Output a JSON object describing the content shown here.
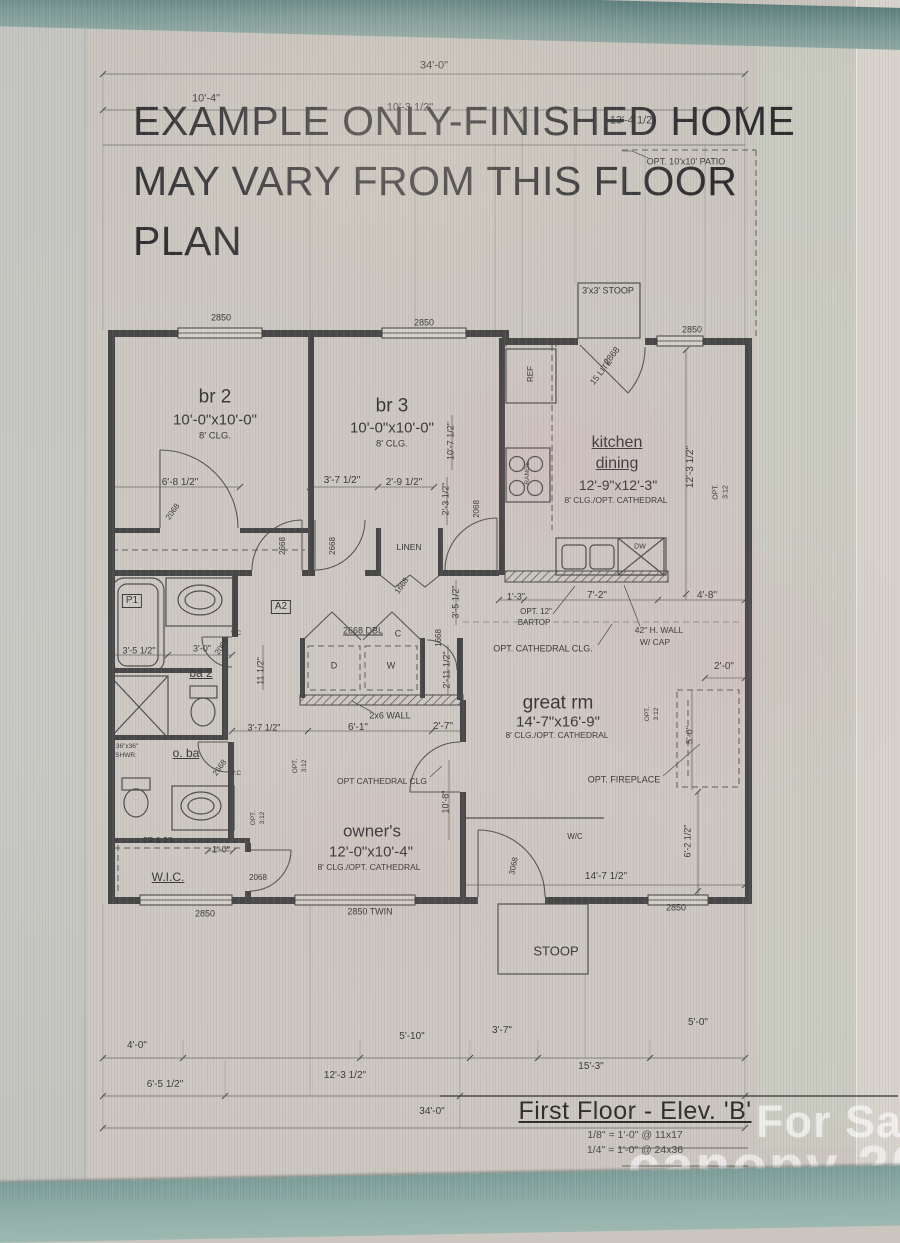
{
  "colors": {
    "teal_band": "#7c9a96",
    "paper": "#cac6bf",
    "wall": "#484848",
    "ink": "#3a3a3a",
    "watermark": "#ffffff"
  },
  "disclaimer": {
    "line1": "EXAMPLE ONLY-FINISHED HOME",
    "line2": "MAY VARY FROM THIS FLOOR",
    "line3": "PLAN"
  },
  "title_block": {
    "title": "First Floor - Elev. 'B'",
    "scale1": "1/8\" = 1'-0\" @ 11x17",
    "scale2": "1/4\" = 1'-0\" @ 24x36"
  },
  "watermarks": {
    "for_sale": "For Sale",
    "brand_year": "canopy 2026",
    "mls": "MLS"
  },
  "rooms": [
    {
      "name": "br 2",
      "size": "10'-0\"x10'-0\"",
      "ceiling": "8' CLG."
    },
    {
      "name": "br 3",
      "size": "10'-0\"x10'-0\"",
      "ceiling": "8' CLG."
    },
    {
      "name": "kitchen dining",
      "size": "12'-9\"x12'-3\"",
      "ceiling": "8' CLG./OPT. CATHEDRAL"
    },
    {
      "name": "great rm",
      "size": "14'-7\"x16'-9\"",
      "ceiling": "8' CLG./OPT. CATHEDRAL"
    },
    {
      "name": "owner's",
      "size": "12'-0\"x10'-4\"",
      "ceiling": "8' CLG./OPT. CATHEDRAL"
    },
    {
      "name": "ba 2"
    },
    {
      "name": "o. ba"
    },
    {
      "name": "W.I.C."
    },
    {
      "name": "LINEN"
    },
    {
      "name": "STOOP"
    }
  ],
  "plan_labels": [
    {
      "t": "34'-0\"",
      "x": 434,
      "y": 66,
      "s": 11,
      "n": "dim-overall-top"
    },
    {
      "t": "10'-4\"",
      "x": 206,
      "y": 99,
      "s": 11,
      "n": "dim"
    },
    {
      "t": "10'-3 1/2\"",
      "x": 410,
      "y": 108,
      "s": 11,
      "n": "dim"
    },
    {
      "t": "13'-4 1/2\"",
      "x": 633,
      "y": 121,
      "s": 11,
      "n": "dim"
    },
    {
      "t": "OPT. 10'x10' PATIO",
      "x": 686,
      "y": 162,
      "s": 9,
      "n": "note-opt-patio"
    },
    {
      "t": "3'x3' STOOP",
      "x": 608,
      "y": 291,
      "s": 9,
      "n": "label-stoop-top"
    },
    {
      "t": "2850",
      "x": 221,
      "y": 318,
      "s": 9,
      "n": "window-tag"
    },
    {
      "t": "2850",
      "x": 424,
      "y": 323,
      "s": 9,
      "n": "window-tag"
    },
    {
      "t": "2850",
      "x": 692,
      "y": 330,
      "s": 9,
      "n": "window-tag"
    },
    {
      "t": "2868",
      "x": 612,
      "y": 356,
      "s": 9,
      "r": -52,
      "n": "door-tag"
    },
    {
      "t": "15 LITE",
      "x": 601,
      "y": 372,
      "s": 8.5,
      "r": -52,
      "n": "door-tag"
    },
    {
      "t": "br 2",
      "x": 215,
      "y": 397,
      "s": 19,
      "n": "room-br2"
    },
    {
      "t": "10'-0\"x10'-0\"",
      "x": 215,
      "y": 420,
      "s": 15,
      "n": "room-br2-size"
    },
    {
      "t": "8' CLG.",
      "x": 215,
      "y": 436,
      "s": 9.5,
      "n": "room-br2-clg"
    },
    {
      "t": "br 3",
      "x": 392,
      "y": 406,
      "s": 19,
      "n": "room-br3"
    },
    {
      "t": "10'-0\"x10'-0\"",
      "x": 392,
      "y": 428,
      "s": 15,
      "n": "room-br3-size"
    },
    {
      "t": "8' CLG.",
      "x": 392,
      "y": 444,
      "s": 9.5,
      "n": "room-br3-clg"
    },
    {
      "t": "kitchen",
      "x": 617,
      "y": 443,
      "s": 16,
      "u": true,
      "n": "room-kitchen"
    },
    {
      "t": "dining",
      "x": 617,
      "y": 464,
      "s": 16,
      "u": true,
      "n": "room-dining"
    },
    {
      "t": "12'-9\"x12'-3\"",
      "x": 618,
      "y": 485,
      "s": 14,
      "n": "room-kitchen-size"
    },
    {
      "t": "8' CLG./OPT. CATHEDRAL",
      "x": 616,
      "y": 500,
      "s": 8.5,
      "n": "room-kitchen-clg"
    },
    {
      "t": "12'-3 1/2\"",
      "x": 691,
      "y": 467,
      "s": 10,
      "r": -90,
      "n": "dim"
    },
    {
      "t": "OPT.",
      "x": 716,
      "y": 492,
      "s": 7,
      "r": -90,
      "n": "roof-pitch"
    },
    {
      "t": "3:12",
      "x": 726,
      "y": 492,
      "s": 7,
      "r": -90,
      "n": "roof-pitch"
    },
    {
      "t": "REF",
      "x": 531,
      "y": 374,
      "s": 8,
      "r": -90,
      "n": "fixture-ref"
    },
    {
      "t": "RANGE",
      "x": 528,
      "y": 473,
      "s": 6.5,
      "r": -90,
      "n": "fixture-range"
    },
    {
      "t": "DW",
      "x": 640,
      "y": 547,
      "s": 7,
      "n": "fixture-dw"
    },
    {
      "t": "6'-8 1/2\"",
      "x": 180,
      "y": 483,
      "s": 10,
      "n": "dim"
    },
    {
      "t": "3'-7 1/2\"",
      "x": 342,
      "y": 481,
      "s": 10,
      "n": "dim"
    },
    {
      "t": "2'-9 1/2\"",
      "x": 404,
      "y": 483,
      "s": 10,
      "n": "dim"
    },
    {
      "t": "10'-7 1/2\"",
      "x": 451,
      "y": 441,
      "s": 9,
      "r": -90,
      "n": "dim"
    },
    {
      "t": "2'-3 1/2\"",
      "x": 446,
      "y": 499,
      "s": 9,
      "r": -90,
      "n": "dim"
    },
    {
      "t": "2068",
      "x": 477,
      "y": 509,
      "s": 8,
      "r": -90,
      "n": "door-tag"
    },
    {
      "t": "2068",
      "x": 173,
      "y": 512,
      "s": 8,
      "r": -55,
      "n": "door-tag"
    },
    {
      "t": "2668",
      "x": 283,
      "y": 546,
      "s": 8,
      "r": -90,
      "n": "door-tag"
    },
    {
      "t": "2668",
      "x": 333,
      "y": 546,
      "s": 8,
      "r": -90,
      "n": "door-tag"
    },
    {
      "t": "LINEN",
      "x": 409,
      "y": 547,
      "s": 8.5,
      "n": "label-linen"
    },
    {
      "t": "1668",
      "x": 402,
      "y": 586,
      "s": 8,
      "r": -55,
      "n": "door-tag"
    },
    {
      "t": "3'-5 1/2\"",
      "x": 456,
      "y": 602,
      "s": 9,
      "r": -90,
      "n": "dim"
    },
    {
      "t": "2'-11 1/2\"",
      "x": 447,
      "y": 670,
      "s": 9,
      "r": -90,
      "n": "dim"
    },
    {
      "t": "1668",
      "x": 439,
      "y": 638,
      "s": 8,
      "r": -90,
      "n": "door-tag"
    },
    {
      "t": "2668 DBL",
      "x": 363,
      "y": 631,
      "s": 9,
      "u": true,
      "n": "door-tag"
    },
    {
      "t": "C",
      "x": 398,
      "y": 634,
      "s": 9,
      "n": "label-closet"
    },
    {
      "t": "D",
      "x": 334,
      "y": 666,
      "s": 9,
      "n": "fixture-dryer"
    },
    {
      "t": "W",
      "x": 391,
      "y": 666,
      "s": 9,
      "n": "fixture-washer"
    },
    {
      "t": "2x6 WALL",
      "x": 390,
      "y": 716,
      "s": 9,
      "n": "note-2x6-wall"
    },
    {
      "t": "6'-1\"",
      "x": 358,
      "y": 728,
      "s": 10,
      "n": "dim"
    },
    {
      "t": "2'-7\"",
      "x": 443,
      "y": 727,
      "s": 10,
      "n": "dim"
    },
    {
      "t": "3'-7 1/2\"",
      "x": 264,
      "y": 728,
      "s": 9,
      "n": "dim"
    },
    {
      "t": "P1",
      "x": 132,
      "y": 601,
      "s": 10,
      "b": true,
      "n": "tag-p1"
    },
    {
      "t": "A2",
      "x": 281,
      "y": 607,
      "s": 10,
      "b": true,
      "n": "tag-a2"
    },
    {
      "t": "V.C",
      "x": 236,
      "y": 634,
      "s": 6.5,
      "n": "note-vc"
    },
    {
      "t": "V.C",
      "x": 236,
      "y": 774,
      "s": 6.5,
      "n": "note-vc"
    },
    {
      "t": "3'-5 1/2\"",
      "x": 139,
      "y": 651,
      "s": 9,
      "n": "dim"
    },
    {
      "t": "3'-0\"",
      "x": 202,
      "y": 649,
      "s": 9,
      "n": "dim"
    },
    {
      "t": "ba 2",
      "x": 201,
      "y": 673,
      "s": 12,
      "u": true,
      "n": "room-ba2"
    },
    {
      "t": "11 1/2\"",
      "x": 261,
      "y": 671,
      "s": 9,
      "r": -90,
      "n": "dim"
    },
    {
      "t": "2068",
      "x": 222,
      "y": 647,
      "s": 8,
      "r": -55,
      "n": "door-tag"
    },
    {
      "t": "36\"x36\"",
      "x": 127,
      "y": 747,
      "s": 6.5,
      "n": "fixture-shower-size"
    },
    {
      "t": "SHWR.",
      "x": 126,
      "y": 756,
      "s": 6.5,
      "n": "fixture-shower"
    },
    {
      "t": "o. ba",
      "x": 186,
      "y": 753,
      "s": 12,
      "u": true,
      "n": "room-oba"
    },
    {
      "t": "2668",
      "x": 220,
      "y": 768,
      "s": 8,
      "r": -55,
      "n": "door-tag"
    },
    {
      "t": "2R & 2S",
      "x": 158,
      "y": 841,
      "s": 8,
      "n": "note-rods-shelves"
    },
    {
      "t": "1'-0\"",
      "x": 221,
      "y": 850,
      "s": 9,
      "n": "dim"
    },
    {
      "t": "W.I.C.",
      "x": 168,
      "y": 877,
      "s": 12,
      "u": true,
      "n": "room-wic"
    },
    {
      "t": "2068",
      "x": 258,
      "y": 878,
      "s": 8,
      "n": "door-tag"
    },
    {
      "t": "owner's",
      "x": 372,
      "y": 831,
      "s": 17,
      "n": "room-owners"
    },
    {
      "t": "12'-0\"x10'-4\"",
      "x": 371,
      "y": 852,
      "s": 15,
      "n": "room-owners-size"
    },
    {
      "t": "8' CLG./OPT. CATHEDRAL",
      "x": 369,
      "y": 867,
      "s": 8.5,
      "n": "room-owners-clg"
    },
    {
      "t": "OPT CATHEDRAL CLG",
      "x": 382,
      "y": 781,
      "s": 8.5,
      "n": "note-cathedral"
    },
    {
      "t": "OPT.",
      "x": 296,
      "y": 766,
      "s": 6.5,
      "r": -90,
      "n": "roof-pitch"
    },
    {
      "t": "3:12",
      "x": 305,
      "y": 766,
      "s": 6.5,
      "r": -90,
      "n": "roof-pitch"
    },
    {
      "t": "OPT.",
      "x": 254,
      "y": 818,
      "s": 6.5,
      "r": -90,
      "n": "roof-pitch"
    },
    {
      "t": "3:12",
      "x": 263,
      "y": 818,
      "s": 6.5,
      "r": -90,
      "n": "roof-pitch"
    },
    {
      "t": "10'-8\"",
      "x": 446,
      "y": 802,
      "s": 9,
      "r": -90,
      "n": "dim"
    },
    {
      "t": "great rm",
      "x": 558,
      "y": 703,
      "s": 19,
      "n": "room-greatrm"
    },
    {
      "t": "14'-7\"x16'-9\"",
      "x": 558,
      "y": 722,
      "s": 15,
      "n": "room-greatrm-size"
    },
    {
      "t": "8' CLG./OPT. CATHEDRAL",
      "x": 557,
      "y": 735,
      "s": 8.5,
      "n": "room-greatrm-clg"
    },
    {
      "t": "OPT. CATHEDRAL CLG.",
      "x": 543,
      "y": 649,
      "s": 9,
      "n": "note-cathedral"
    },
    {
      "t": "OPT. 12\"",
      "x": 536,
      "y": 612,
      "s": 8,
      "n": "note-bartop"
    },
    {
      "t": "BARTOP",
      "x": 534,
      "y": 623,
      "s": 8,
      "n": "note-bartop"
    },
    {
      "t": "42\" H. WALL",
      "x": 659,
      "y": 630,
      "s": 8.5,
      "n": "note-half-wall"
    },
    {
      "t": "W/ CAP",
      "x": 655,
      "y": 642,
      "s": 8.5,
      "n": "note-half-wall"
    },
    {
      "t": "1'-3\"",
      "x": 516,
      "y": 597,
      "s": 9,
      "n": "dim"
    },
    {
      "t": "7'-2\"",
      "x": 597,
      "y": 596,
      "s": 10,
      "n": "dim"
    },
    {
      "t": "4'-8\"",
      "x": 707,
      "y": 596,
      "s": 10,
      "n": "dim"
    },
    {
      "t": "2'-0\"",
      "x": 724,
      "y": 667,
      "s": 10,
      "n": "dim"
    },
    {
      "t": "OPT.",
      "x": 648,
      "y": 714,
      "s": 6.5,
      "r": -90,
      "n": "roof-pitch"
    },
    {
      "t": "3:12",
      "x": 657,
      "y": 714,
      "s": 6.5,
      "r": -90,
      "n": "roof-pitch"
    },
    {
      "t": "5'-0\"",
      "x": 690,
      "y": 735,
      "s": 9,
      "r": -90,
      "n": "dim"
    },
    {
      "t": "OPT. FIREPLACE",
      "x": 624,
      "y": 780,
      "s": 9,
      "n": "note-opt-fireplace"
    },
    {
      "t": "6'-2 1/2\"",
      "x": 688,
      "y": 841,
      "s": 9,
      "r": -90,
      "n": "dim"
    },
    {
      "t": "14'-7 1/2\"",
      "x": 606,
      "y": 877,
      "s": 10,
      "n": "dim"
    },
    {
      "t": "W/C",
      "x": 575,
      "y": 837,
      "s": 8,
      "n": "label-wc"
    },
    {
      "t": "3068",
      "x": 514,
      "y": 866,
      "s": 8,
      "r": -78,
      "n": "door-tag"
    },
    {
      "t": "2850",
      "x": 205,
      "y": 914,
      "s": 9,
      "n": "window-tag"
    },
    {
      "t": "2850 TWIN",
      "x": 370,
      "y": 912,
      "s": 9,
      "n": "window-tag"
    },
    {
      "t": "2850",
      "x": 676,
      "y": 908,
      "s": 9,
      "n": "window-tag"
    },
    {
      "t": "STOOP",
      "x": 556,
      "y": 951,
      "s": 13,
      "n": "label-stoop-bottom"
    },
    {
      "t": "4'-0\"",
      "x": 137,
      "y": 1046,
      "s": 10,
      "n": "dim"
    },
    {
      "t": "5'-10\"",
      "x": 412,
      "y": 1037,
      "s": 10,
      "n": "dim"
    },
    {
      "t": "3'-7\"",
      "x": 502,
      "y": 1031,
      "s": 10,
      "n": "dim"
    },
    {
      "t": "5'-0\"",
      "x": 698,
      "y": 1023,
      "s": 10,
      "n": "dim"
    },
    {
      "t": "6'-5 1/2\"",
      "x": 165,
      "y": 1085,
      "s": 10,
      "n": "dim"
    },
    {
      "t": "12'-3 1/2\"",
      "x": 345,
      "y": 1076,
      "s": 10,
      "n": "dim"
    },
    {
      "t": "15'-3\"",
      "x": 591,
      "y": 1067,
      "s": 10,
      "n": "dim"
    },
    {
      "t": "34'-0\"",
      "x": 432,
      "y": 1112,
      "s": 10,
      "n": "dim-overall-bottom"
    }
  ]
}
